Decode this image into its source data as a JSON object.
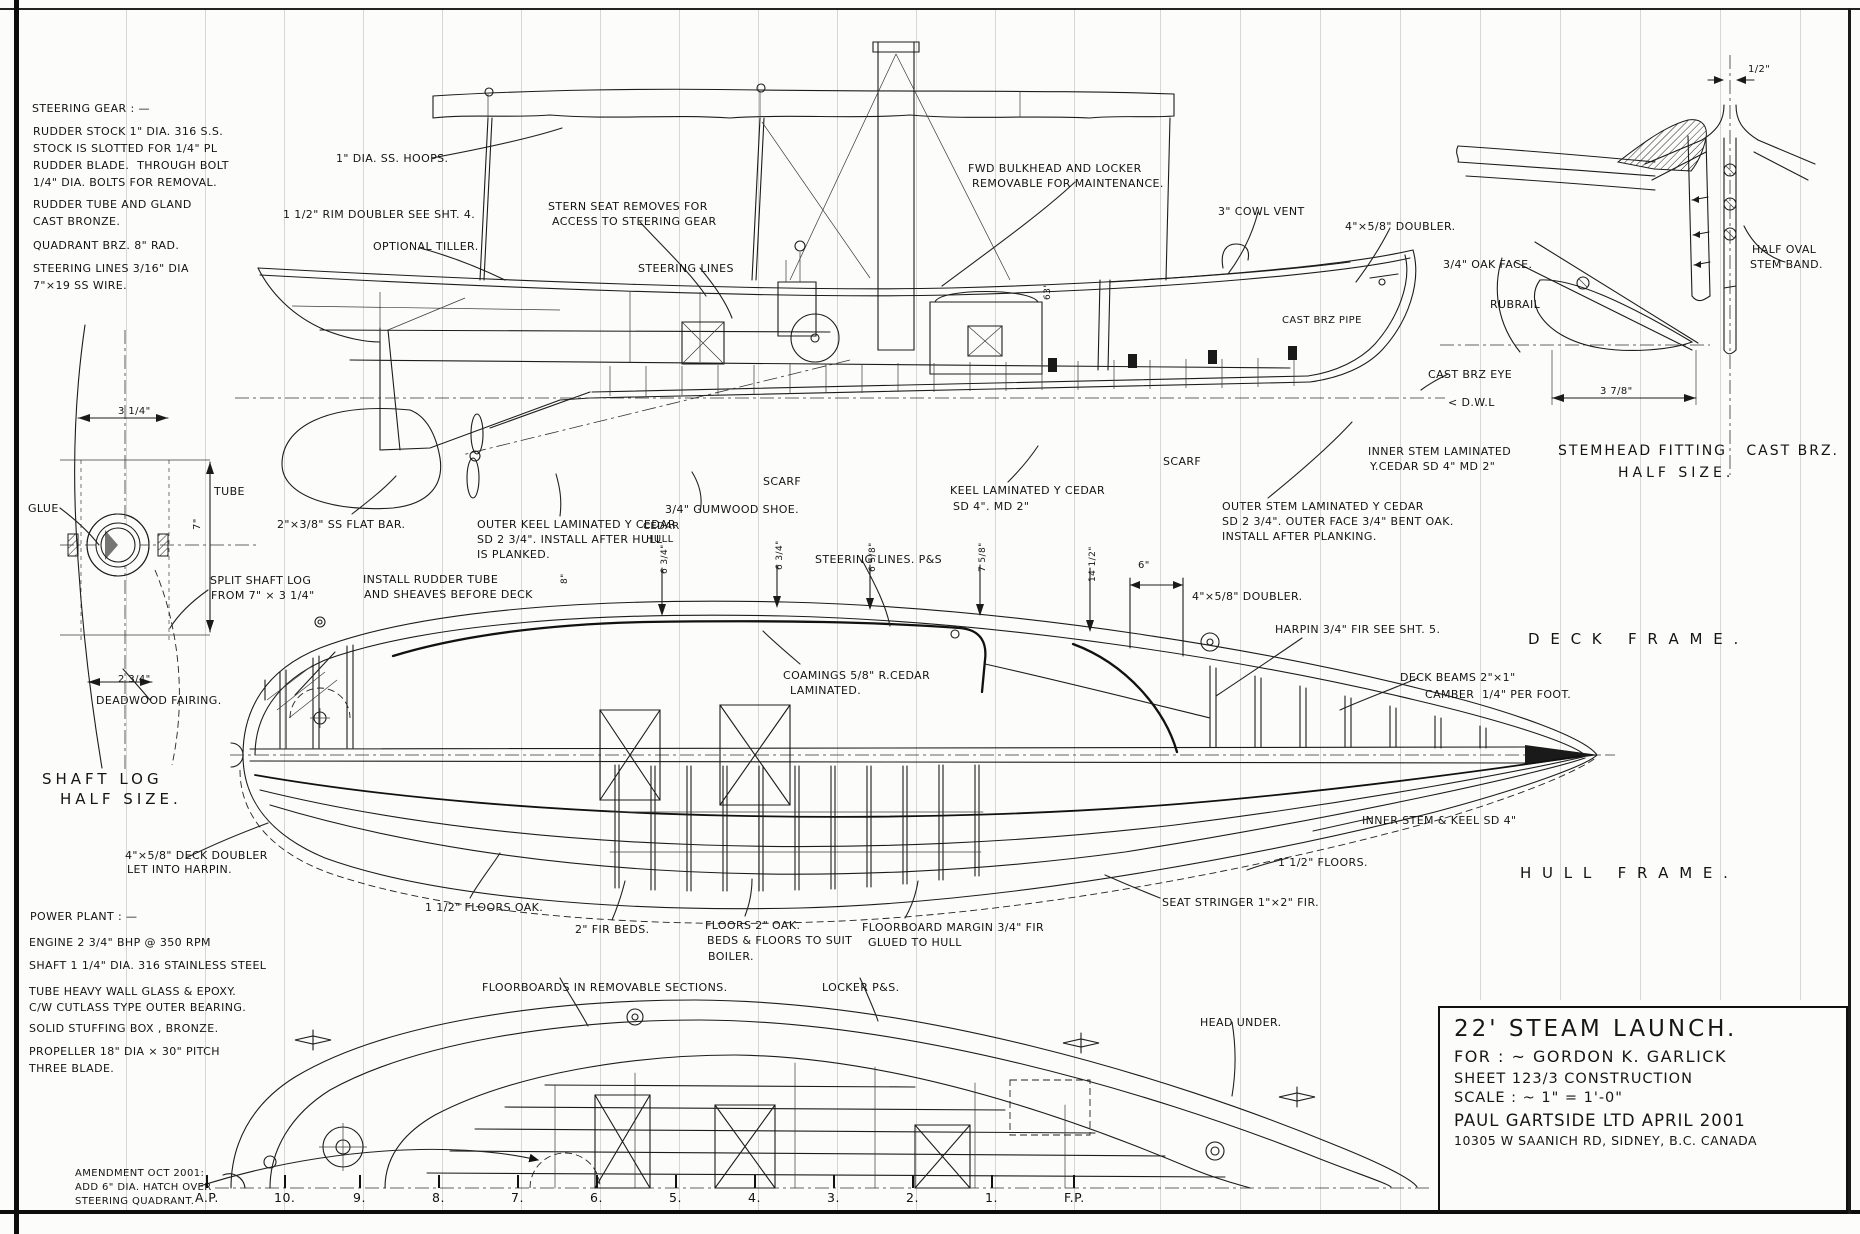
{
  "sheet": {
    "description": "Hand-drawn boat construction blueprint, 22 ft steam launch"
  },
  "title_block": {
    "title": "22' STEAM LAUNCH.",
    "for_line": "FOR : ~  GORDON  K. GARLICK",
    "sheet_line": "SHEET  123/3   CONSTRUCTION",
    "scale_line": "SCALE  : ~   1\" = 1'-0\"",
    "firm_line": "PAUL  GARTSIDE  LTD    APRIL 2001",
    "address_line": "10305 W SAANICH RD,  SIDNEY,  B.C.  CANADA"
  },
  "stations": [
    {
      "label": "A.P.",
      "x": 205
    },
    {
      "label": "10.",
      "x": 284
    },
    {
      "label": "9.",
      "x": 363
    },
    {
      "label": "8.",
      "x": 442
    },
    {
      "label": "7.",
      "x": 521
    },
    {
      "label": "6.",
      "x": 600
    },
    {
      "label": "5.",
      "x": 679
    },
    {
      "label": "4.",
      "x": 758
    },
    {
      "label": "3.",
      "x": 837
    },
    {
      "label": "2.",
      "x": 916
    },
    {
      "label": "1.",
      "x": 995
    },
    {
      "label": "F.P.",
      "x": 1074
    }
  ],
  "grid": {
    "extra_xs": [
      126,
      1160,
      1240,
      1320,
      1400,
      1480,
      1560,
      1640,
      1720,
      1800
    ]
  },
  "annotations": [
    {
      "t": "STEERING GEAR : —",
      "x": 32,
      "y": 102
    },
    {
      "t": "RUDDER STOCK 1\" DIA. 316 S.S.",
      "x": 33,
      "y": 125
    },
    {
      "t": "STOCK IS SLOTTED FOR 1/4\" PL",
      "x": 33,
      "y": 142
    },
    {
      "t": "RUDDER BLADE.  THROUGH BOLT",
      "x": 33,
      "y": 159
    },
    {
      "t": "1/4\" DIA. BOLTS FOR REMOVAL.",
      "x": 33,
      "y": 176
    },
    {
      "t": "RUDDER TUBE AND GLAND",
      "x": 33,
      "y": 198
    },
    {
      "t": "CAST BRONZE.",
      "x": 33,
      "y": 215
    },
    {
      "t": "QUADRANT BRZ. 8\" RAD.",
      "x": 33,
      "y": 239
    },
    {
      "t": "STEERING LINES 3/16\" DIA",
      "x": 33,
      "y": 262
    },
    {
      "t": "7\"×19 SS WIRE.",
      "x": 33,
      "y": 279
    },
    {
      "t": "1\" DIA. SS. HOOPS.",
      "x": 336,
      "y": 152
    },
    {
      "t": "1 1/2\" RIM DOUBLER SEE SHT. 4.",
      "x": 283,
      "y": 208
    },
    {
      "t": "OPTIONAL TILLER.",
      "x": 373,
      "y": 240
    },
    {
      "t": "STERN SEAT REMOVES FOR",
      "x": 548,
      "y": 200
    },
    {
      "t": "ACCESS TO STEERING GEAR",
      "x": 552,
      "y": 215
    },
    {
      "t": "STEERING LINES",
      "x": 638,
      "y": 262
    },
    {
      "t": "FWD BULKHEAD AND LOCKER",
      "x": 968,
      "y": 162
    },
    {
      "t": "REMOVABLE FOR MAINTENANCE.",
      "x": 972,
      "y": 177
    },
    {
      "t": "3\" COWL VENT",
      "x": 1218,
      "y": 205
    },
    {
      "t": "4\"×5/8\" DOUBLER.",
      "x": 1345,
      "y": 220
    },
    {
      "t": "63\"",
      "x": 1043,
      "y": 300,
      "rot": 1,
      "fs": 9
    },
    {
      "t": "CAST BRZ PIPE",
      "x": 1282,
      "y": 315,
      "fs": 10
    },
    {
      "t": "3/4\" OAK FACE.",
      "x": 1443,
      "y": 258
    },
    {
      "t": "RUBRAIL",
      "x": 1490,
      "y": 298
    },
    {
      "t": "CAST BRZ EYE",
      "x": 1428,
      "y": 368
    },
    {
      "t": "< D.W.L",
      "x": 1448,
      "y": 396
    },
    {
      "t": "HALF OVAL",
      "x": 1752,
      "y": 243
    },
    {
      "t": "STEM BAND.",
      "x": 1750,
      "y": 258
    },
    {
      "t": "1/2\"",
      "x": 1748,
      "y": 64,
      "fs": 10
    },
    {
      "t": "3 7/8\"",
      "x": 1600,
      "y": 386,
      "fs": 10
    },
    {
      "t": "STEMHEAD FITTING   CAST BRZ.",
      "x": 1558,
      "y": 443,
      "fs": 14,
      "ls": 2
    },
    {
      "t": "HALF SIZE.",
      "x": 1618,
      "y": 465,
      "fs": 14,
      "ls": 4
    },
    {
      "t": "INNER STEM LAMINATED",
      "x": 1368,
      "y": 445
    },
    {
      "t": "Y.CEDAR SD 4\" MD 2\"",
      "x": 1370,
      "y": 460
    },
    {
      "t": "OUTER STEM LAMINATED Y CEDAR",
      "x": 1222,
      "y": 500
    },
    {
      "t": "SD 2 3/4\". OUTER FACE 3/4\" BENT OAK.",
      "x": 1222,
      "y": 515
    },
    {
      "t": "INSTALL AFTER PLANKING.",
      "x": 1222,
      "y": 530
    },
    {
      "t": "SCARF",
      "x": 1163,
      "y": 455
    },
    {
      "t": "SCARF",
      "x": 763,
      "y": 475
    },
    {
      "t": "KEEL LAMINATED Y CEDAR",
      "x": 950,
      "y": 484
    },
    {
      "t": "SD 4\". MD 2\"",
      "x": 953,
      "y": 500
    },
    {
      "t": "3/4\" GUMWOOD SHOE.",
      "x": 665,
      "y": 503
    },
    {
      "t": "CEDAR",
      "x": 643,
      "y": 521,
      "fs": 10
    },
    {
      "t": "HULL",
      "x": 646,
      "y": 534,
      "fs": 10
    },
    {
      "t": "2\"×3/8\" SS FLAT BAR.",
      "x": 277,
      "y": 518
    },
    {
      "t": "OUTER KEEL LAMINATED Y CEDAR",
      "x": 477,
      "y": 518
    },
    {
      "t": "SD 2 3/4\". INSTALL AFTER HULL",
      "x": 477,
      "y": 533
    },
    {
      "t": "IS PLANKED.",
      "x": 477,
      "y": 548
    },
    {
      "t": "GLUE",
      "x": 28,
      "y": 502
    },
    {
      "t": "TUBE",
      "x": 214,
      "y": 485
    },
    {
      "t": "3 1/4\"",
      "x": 118,
      "y": 406,
      "fs": 10
    },
    {
      "t": "7\"",
      "x": 192,
      "y": 530,
      "rot": 1,
      "fs": 10
    },
    {
      "t": "2 3/4\"",
      "x": 118,
      "y": 674,
      "fs": 10
    },
    {
      "t": "SPLIT SHAFT LOG",
      "x": 210,
      "y": 574
    },
    {
      "t": "FROM 7\" × 3 1/4\"",
      "x": 211,
      "y": 589
    },
    {
      "t": "DEADWOOD FAIRING.",
      "x": 96,
      "y": 694
    },
    {
      "t": "SHAFT LOG",
      "x": 42,
      "y": 770,
      "fs": 15,
      "ls": 4
    },
    {
      "t": "HALF SIZE.",
      "x": 60,
      "y": 790,
      "fs": 15,
      "ls": 4
    },
    {
      "t": "4\"×5/8\" DECK DOUBLER",
      "x": 125,
      "y": 849
    },
    {
      "t": "LET INTO HARPIN.",
      "x": 127,
      "y": 863
    },
    {
      "t": "INSTALL RUDDER TUBE",
      "x": 363,
      "y": 573
    },
    {
      "t": "AND SHEAVES BEFORE DECK",
      "x": 364,
      "y": 588
    },
    {
      "t": "8\"",
      "x": 560,
      "y": 584,
      "rot": 1,
      "fs": 9
    },
    {
      "t": "STEERING LINES. P&S",
      "x": 815,
      "y": 553
    },
    {
      "t": "COAMINGS 5/8\" R.CEDAR",
      "x": 783,
      "y": 669
    },
    {
      "t": "LAMINATED.",
      "x": 790,
      "y": 684
    },
    {
      "t": "6 3/4\"",
      "x": 660,
      "y": 574,
      "rot": 1,
      "fs": 9
    },
    {
      "t": "6 3/4\"",
      "x": 775,
      "y": 570,
      "rot": 1,
      "fs": 9
    },
    {
      "t": "6 5/8\"",
      "x": 868,
      "y": 572,
      "rot": 1,
      "fs": 9
    },
    {
      "t": "7 5/8\"",
      "x": 978,
      "y": 572,
      "rot": 1,
      "fs": 9
    },
    {
      "t": "14 1/2\"",
      "x": 1088,
      "y": 582,
      "rot": 1,
      "fs": 9
    },
    {
      "t": "6\"",
      "x": 1138,
      "y": 560,
      "fs": 10
    },
    {
      "t": "4\"×5/8\" DOUBLER.",
      "x": 1192,
      "y": 590
    },
    {
      "t": "HARPIN 3/4\" FIR SEE SHT. 5.",
      "x": 1275,
      "y": 623
    },
    {
      "t": "D E C K   F R A M E .",
      "x": 1528,
      "y": 630,
      "fs": 15,
      "ls": 3
    },
    {
      "t": "DECK BEAMS 2\"×1\"",
      "x": 1400,
      "y": 671
    },
    {
      "t": "CAMBER  1/4\" PER FOOT.",
      "x": 1425,
      "y": 688
    },
    {
      "t": "H U L L   F R A M E .",
      "x": 1520,
      "y": 864,
      "fs": 15,
      "ls": 3
    },
    {
      "t": "INNER STEM & KEEL SD 4\"",
      "x": 1362,
      "y": 814
    },
    {
      "t": "1 1/2\" FLOORS.",
      "x": 1278,
      "y": 856
    },
    {
      "t": "SEAT STRINGER 1\"×2\" FIR.",
      "x": 1162,
      "y": 896
    },
    {
      "t": "1 1/2\" FLOORS OAK.",
      "x": 425,
      "y": 901
    },
    {
      "t": "2\" FIR BEDS.",
      "x": 575,
      "y": 923
    },
    {
      "t": "FLOORS 2\" OAK.",
      "x": 705,
      "y": 919
    },
    {
      "t": "BEDS & FLOORS TO SUIT",
      "x": 707,
      "y": 934
    },
    {
      "t": "BOILER.",
      "x": 708,
      "y": 950
    },
    {
      "t": "FLOORBOARD MARGIN 3/4\" FIR",
      "x": 862,
      "y": 921
    },
    {
      "t": "GLUED TO HULL",
      "x": 868,
      "y": 936
    },
    {
      "t": "FLOORBOARDS IN REMOVABLE SECTIONS.",
      "x": 482,
      "y": 981
    },
    {
      "t": "LOCKER P&S.",
      "x": 822,
      "y": 981
    },
    {
      "t": "HEAD UNDER.",
      "x": 1200,
      "y": 1016
    },
    {
      "t": "AMENDMENT OCT 2001:",
      "x": 75,
      "y": 1168,
      "fs": 10
    },
    {
      "t": "ADD 6\" DIA. HATCH OVER",
      "x": 75,
      "y": 1182,
      "fs": 10
    },
    {
      "t": "STEERING QUADRANT.",
      "x": 75,
      "y": 1196,
      "fs": 10
    },
    {
      "t": "POWER PLANT : —",
      "x": 30,
      "y": 910
    },
    {
      "t": "ENGINE 2 3/4\" BHP @ 350 RPM",
      "x": 29,
      "y": 936
    },
    {
      "t": "SHAFT 1 1/4\" DIA. 316 STAINLESS STEEL",
      "x": 29,
      "y": 959
    },
    {
      "t": "TUBE HEAVY WALL GLASS & EPOXY.",
      "x": 29,
      "y": 985
    },
    {
      "t": "C/W CUTLASS TYPE OUTER BEARING.",
      "x": 29,
      "y": 1001
    },
    {
      "t": "SOLID STUFFING BOX , BRONZE.",
      "x": 29,
      "y": 1022
    },
    {
      "t": "PROPELLER 18\" DIA × 30\" PITCH",
      "x": 29,
      "y": 1045
    },
    {
      "t": "THREE BLADE.",
      "x": 29,
      "y": 1062
    }
  ]
}
